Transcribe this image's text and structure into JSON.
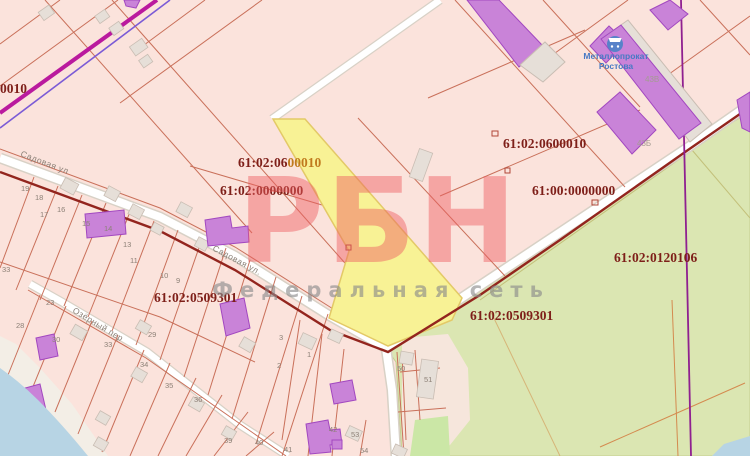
{
  "map": {
    "watermark": {
      "big": "РБН",
      "sub": "Федеральная сеть"
    },
    "poi": {
      "name_line1": "Металлопрокат",
      "name_line2": "Ростова",
      "icon": "shopping-cart-icon"
    },
    "colors": {
      "highlighted_parcel": "#f8f295",
      "parcel_fill": "#fbe3dc",
      "parcel_border": "#c9705a",
      "cadastral_text": "#7e1f19",
      "watermark_pink": "#ee5e62",
      "vegetation": "#dbe6b2",
      "water": "#b7d4e4",
      "building_purple": "#c983d8"
    },
    "cadastral_labels": [
      {
        "x": 0,
        "y": 93,
        "parts": [
          {
            "t": "0010",
            "c": ""
          }
        ]
      },
      {
        "x": 238,
        "y": 167,
        "parts": [
          {
            "t": "61:02:06",
            "c": ""
          },
          {
            "t": "00010",
            "c": "orange"
          }
        ]
      },
      {
        "x": 220,
        "y": 195,
        "parts": [
          {
            "t": "61:02:0000000",
            "c": ""
          }
        ]
      },
      {
        "x": 503,
        "y": 148,
        "parts": [
          {
            "t": "61:02:0600010",
            "c": ""
          }
        ]
      },
      {
        "x": 532,
        "y": 195,
        "parts": [
          {
            "t": "61:00:0000000",
            "c": ""
          }
        ]
      },
      {
        "x": 614,
        "y": 262,
        "parts": [
          {
            "t": "61:02:0120106",
            "c": ""
          }
        ]
      },
      {
        "x": 470,
        "y": 320,
        "parts": [
          {
            "t": "61:02:0509301",
            "c": ""
          }
        ]
      },
      {
        "x": 154,
        "y": 302,
        "parts": [
          {
            "t": "61:02:0509301",
            "c": ""
          }
        ]
      }
    ],
    "street_labels": [
      {
        "t": "Садовая ул",
        "x": 20,
        "y": 156,
        "angle": 21
      },
      {
        "t": "Садовая ул.",
        "x": 212,
        "y": 250,
        "angle": 28
      },
      {
        "t": "Озёрный пер",
        "x": 72,
        "y": 312,
        "angle": 31
      }
    ],
    "building_labels": [
      {
        "t": "43В",
        "x": 645,
        "y": 82
      },
      {
        "t": "43Б",
        "x": 637,
        "y": 146
      }
    ],
    "parcel_numbers": [
      {
        "t": "19",
        "x": 21,
        "y": 191
      },
      {
        "t": "18",
        "x": 35,
        "y": 200
      },
      {
        "t": "17",
        "x": 40,
        "y": 217
      },
      {
        "t": "16",
        "x": 57,
        "y": 212
      },
      {
        "t": "15",
        "x": 82,
        "y": 226
      },
      {
        "t": "14",
        "x": 104,
        "y": 231
      },
      {
        "t": "13",
        "x": 123,
        "y": 247
      },
      {
        "t": "11",
        "x": 130,
        "y": 263
      },
      {
        "t": "10",
        "x": 160,
        "y": 278
      },
      {
        "t": "9",
        "x": 176,
        "y": 283
      },
      {
        "t": "23",
        "x": 46,
        "y": 305
      },
      {
        "t": "28",
        "x": 16,
        "y": 328
      },
      {
        "t": "33",
        "x": 2,
        "y": 272
      },
      {
        "t": "30",
        "x": 52,
        "y": 342
      },
      {
        "t": "29",
        "x": 148,
        "y": 337
      },
      {
        "t": "33",
        "x": 104,
        "y": 347
      },
      {
        "t": "34",
        "x": 140,
        "y": 367
      },
      {
        "t": "35",
        "x": 165,
        "y": 388
      },
      {
        "t": "36",
        "x": 194,
        "y": 402
      },
      {
        "t": "39",
        "x": 224,
        "y": 443
      },
      {
        "t": "40",
        "x": 255,
        "y": 445
      },
      {
        "t": "41",
        "x": 284,
        "y": 452
      },
      {
        "t": "3",
        "x": 279,
        "y": 340
      },
      {
        "t": "2",
        "x": 277,
        "y": 368
      },
      {
        "t": "1",
        "x": 307,
        "y": 357
      },
      {
        "t": "42",
        "x": 329,
        "y": 432
      },
      {
        "t": "53",
        "x": 351,
        "y": 437
      },
      {
        "t": "54",
        "x": 360,
        "y": 453
      },
      {
        "t": "50",
        "x": 397,
        "y": 371
      },
      {
        "t": "51",
        "x": 424,
        "y": 382
      }
    ]
  }
}
